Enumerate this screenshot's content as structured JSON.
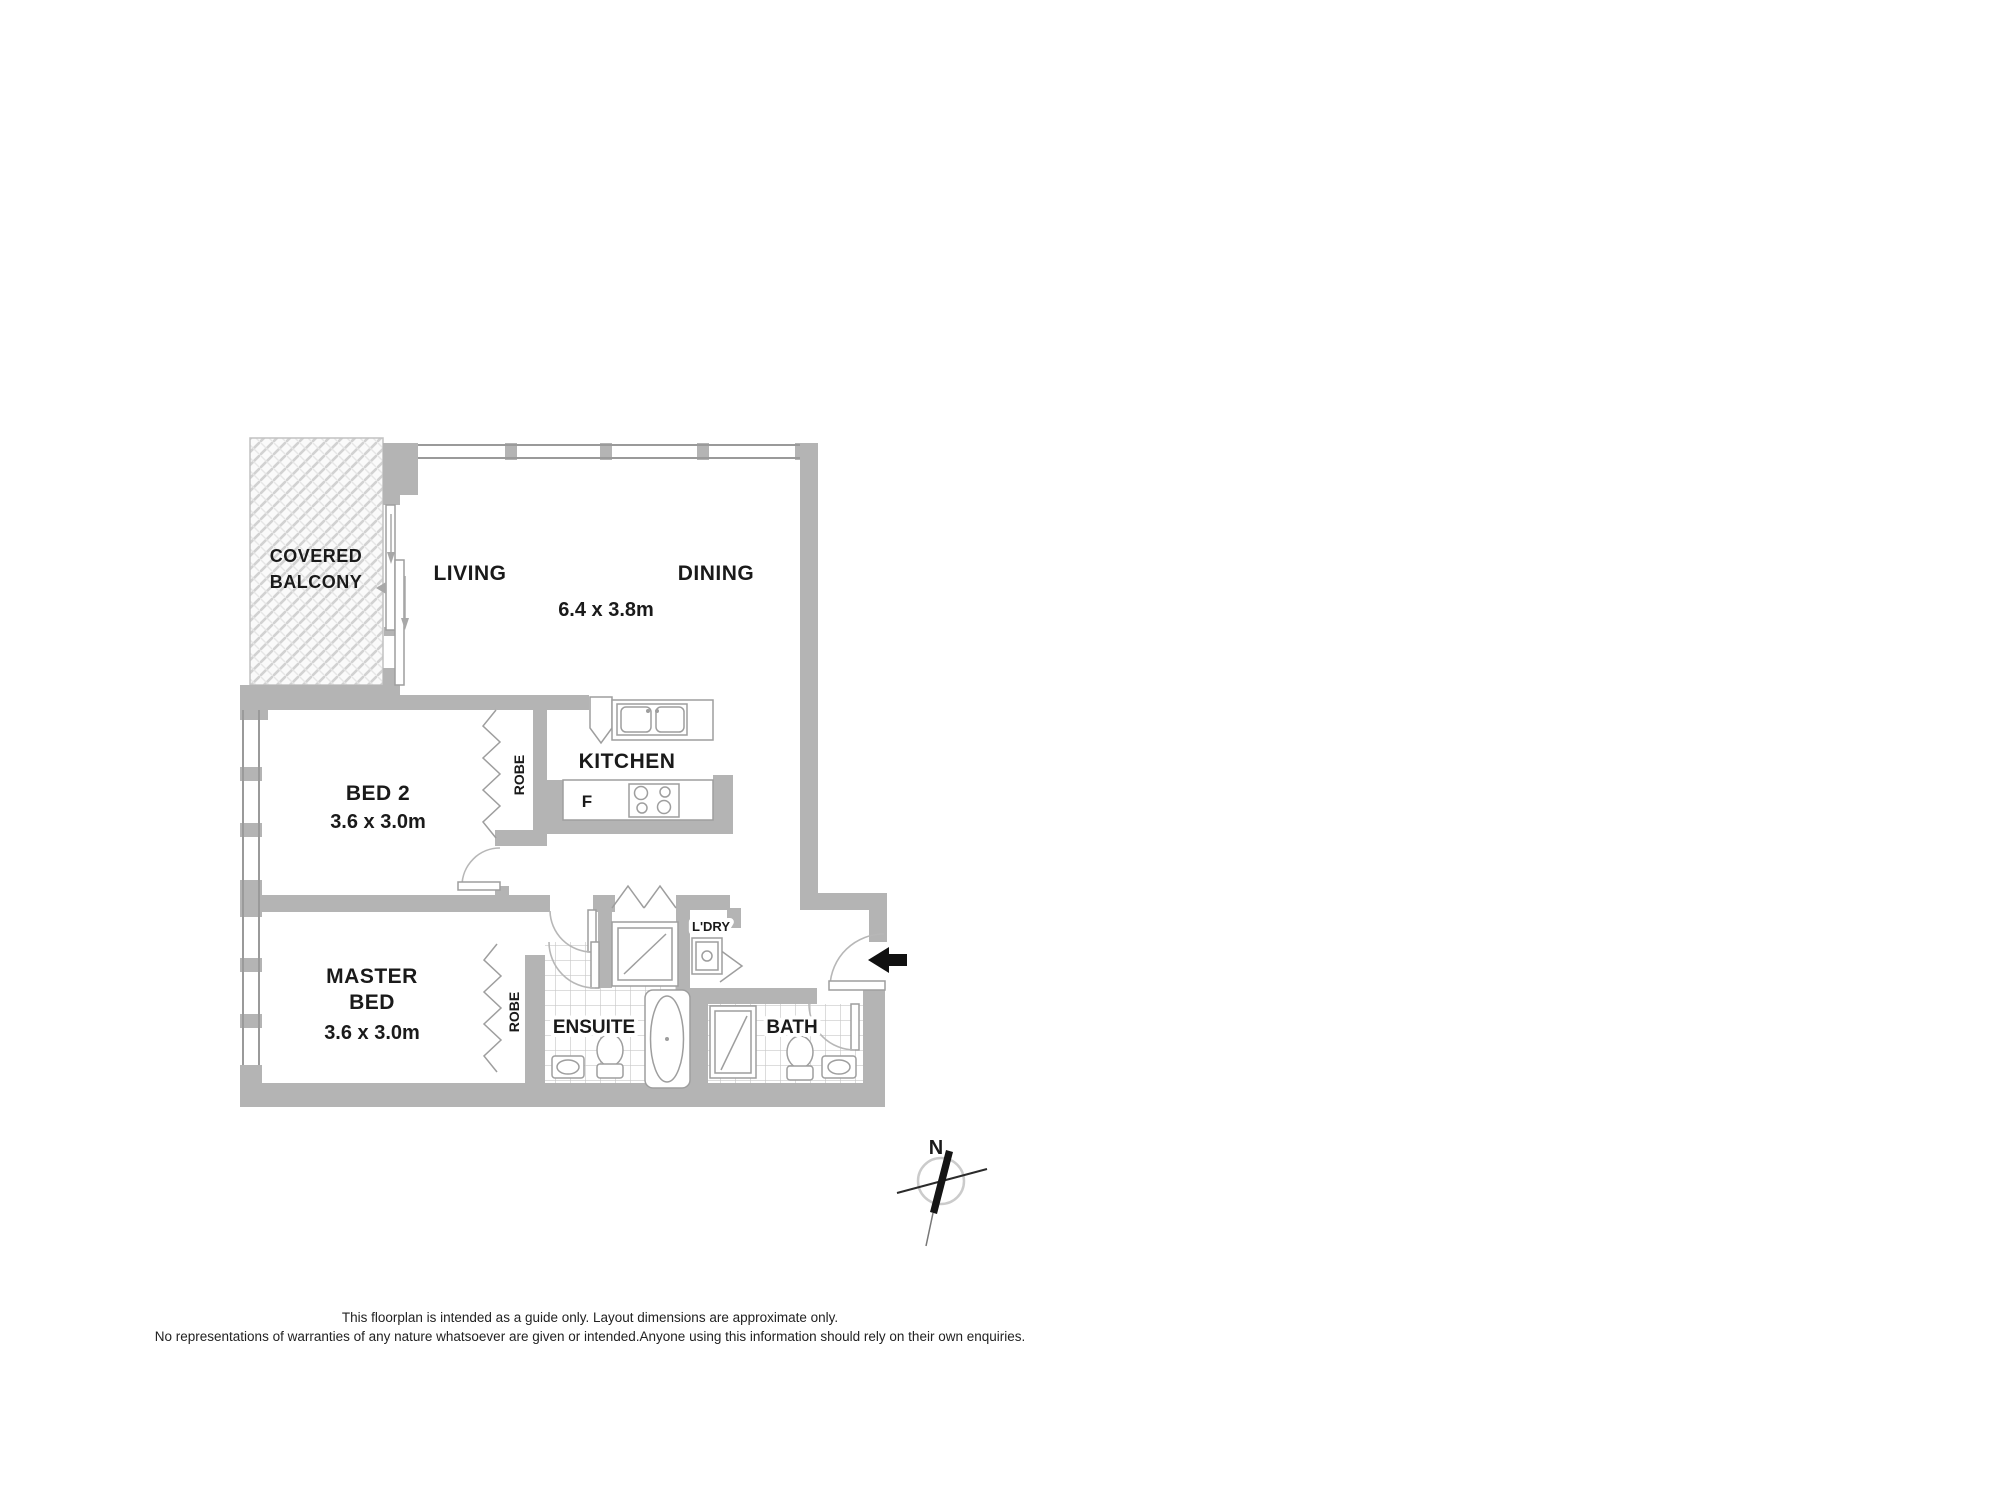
{
  "floorplan": {
    "rooms": {
      "balcony": {
        "label_line1": "COVERED",
        "label_line2": "BALCONY"
      },
      "living": {
        "label": "LIVING"
      },
      "dining": {
        "label": "DINING"
      },
      "living_dining": {
        "dimensions": "6.4 x 3.8m"
      },
      "kitchen": {
        "label": "KITCHEN",
        "fridge": "F"
      },
      "bed2": {
        "label": "BED 2",
        "dimensions": "3.6 x 3.0m",
        "robe": "ROBE"
      },
      "master_bed": {
        "label_line1": "MASTER",
        "label_line2": "BED",
        "dimensions": "3.6 x 3.0m",
        "robe": "ROBE"
      },
      "ensuite": {
        "label": "ENSUITE"
      },
      "bath": {
        "label": "BATH"
      },
      "laundry": {
        "label": "L'DRY"
      }
    },
    "compass": {
      "north": "N"
    },
    "colors": {
      "wall": "#b4b4b4",
      "fixture_line": "#9e9e9e",
      "tile_line": "#c9c9c9",
      "entry_arrow": "#111111"
    }
  },
  "disclaimer": {
    "line1": "This floorplan is intended as a guide only. Layout dimensions are approximate only.",
    "line2": "No representations of warranties of any nature whatsoever are given or intended.Anyone using this information should rely on their own enquiries."
  }
}
